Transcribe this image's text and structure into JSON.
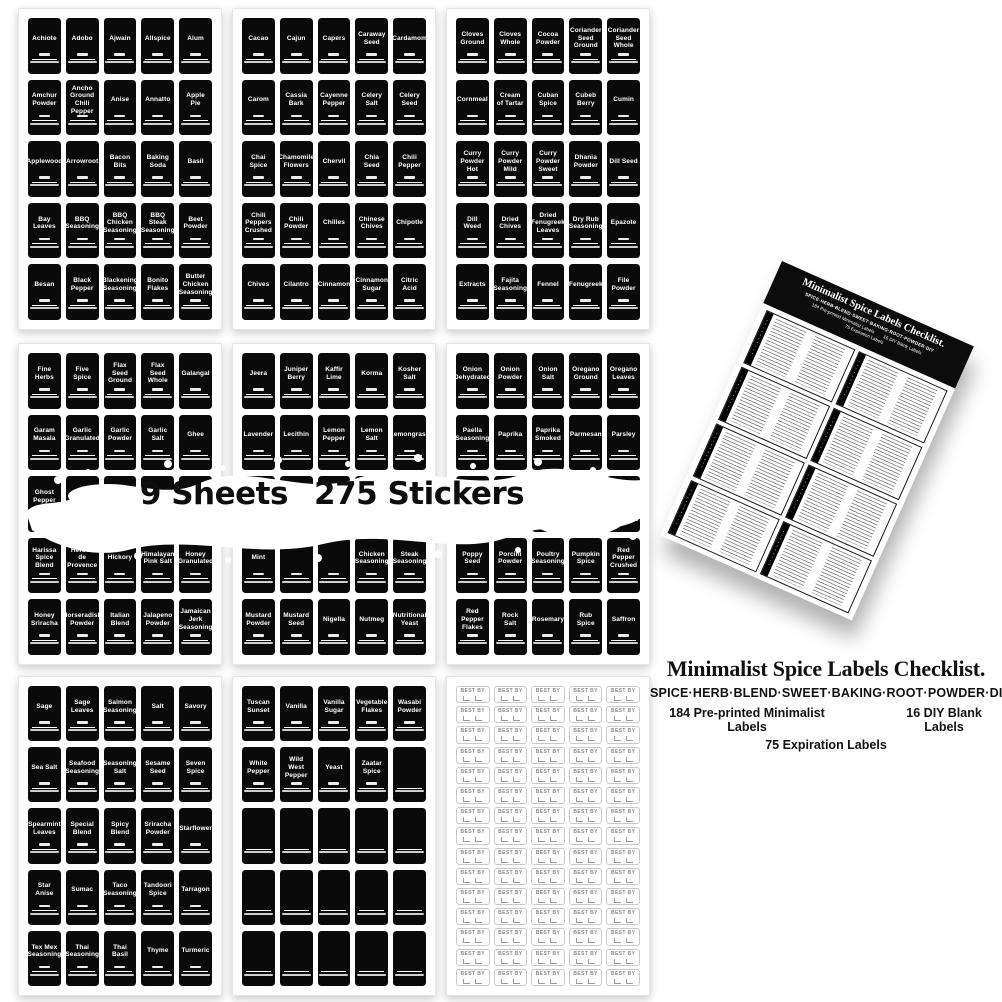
{
  "colors": {
    "background": "#ffffff",
    "label_bg": "#0a0a0a",
    "label_text": "#ffffff",
    "card_header_bg": "#0c0c0c",
    "text": "#111111"
  },
  "banner": {
    "sheets_text": "9 Sheets",
    "stickers_text": "275 Stickers"
  },
  "info": {
    "title": "Minimalist Spice Labels Checklist.",
    "subtitle": "SPICE·HERB·BLEND·SWEET·BAKING·ROOT·POWDER·DIY",
    "line_preprinted": "184 Pre-printed Minimalist Labels",
    "line_blank": "16 DIY Blank Labels",
    "line_expiration": "75 Expiration Labels"
  },
  "card": {
    "title": "Minimalist Spice Labels Checklist.",
    "subtitle": "SPICE·HERB·BLEND·SWEET·BAKING·ROOT·POWDER·DIY",
    "line_preprinted": "184 Pre-printed Minimalist Labels",
    "line_blank": "16 DIY Blank Labels",
    "line_expiration": "75 Expiration Labels",
    "box_count": 8
  },
  "expiration": {
    "text": "BEST BY",
    "rows": 15,
    "cols": 5,
    "count": 75
  },
  "sheets": [
    {
      "name": "sheet-1",
      "rows": 5,
      "cols": 5,
      "labels": [
        "Achiote",
        "Adobo",
        "Ajwain",
        "Allspice",
        "Alum",
        "Amchur Powder",
        "Ancho Ground Chili Pepper",
        "Anise",
        "Annatto",
        "Apple Pie",
        "Applewood",
        "Arrowroot",
        "Bacon Bits",
        "Baking Soda",
        "Basil",
        "Bay Leaves",
        "BBQ Seasoning",
        "BBQ Chicken Seasoning",
        "BBQ Steak Seasoning",
        "Beet Powder",
        "Besan",
        "Black Pepper",
        "Blackening Seasoning",
        "Bonito Flakes",
        "Butter Chicken Seasoning"
      ]
    },
    {
      "name": "sheet-2",
      "rows": 5,
      "cols": 5,
      "labels": [
        "Cacao",
        "Cajun",
        "Capers",
        "Caraway Seed",
        "Cardamom",
        "Carom",
        "Cassia Bark",
        "Cayenne Pepper",
        "Celery Salt",
        "Celery Seed",
        "Chai Spice",
        "Chamomile Flowers",
        "Chervil",
        "Chia Seed",
        "Chili Pepper",
        "Chili Peppers Crushed",
        "Chili Powder",
        "Chilies",
        "Chinese Chives",
        "Chipotle",
        "Chives",
        "Cilantro",
        "Cinnamon",
        "Cinnamon Sugar",
        "Citric Acid"
      ]
    },
    {
      "name": "sheet-3",
      "rows": 5,
      "cols": 5,
      "labels": [
        "Cloves Ground",
        "Cloves Whole",
        "Cocoa Powder",
        "Coriander Seed Ground",
        "Coriander Seed Whole",
        "Cornmeal",
        "Cream of Tartar",
        "Cuban Spice",
        "Cubeb Berry",
        "Cumin",
        "Curry Powder Hot",
        "Curry Powder Mild",
        "Curry Powder Sweet",
        "Dhania Powder",
        "Dill Seed",
        "Dill Weed",
        "Dried Chives",
        "Dried Fenugreek Leaves",
        "Dry Rub Seasoning",
        "Epazote",
        "Extracts",
        "Fajita Seasoning",
        "Fennel",
        "Fenugreek",
        "File Powder"
      ]
    },
    {
      "name": "sheet-4",
      "rows": 5,
      "cols": 5,
      "labels": [
        "Fine Herbs",
        "Five Spice",
        "Flax Seed Ground",
        "Flax Seed Whole",
        "Galangal",
        "Garam Masala",
        "Garlic Granulated",
        "Garlic Powder",
        "Garlic Salt",
        "Ghee",
        "Ghost Pepper",
        "Ginger",
        "",
        "",
        "",
        "Harissa Spice Blend",
        "Herbes de Provence",
        "Hickory",
        "Himalayan Pink Salt",
        "Honey Granulated",
        "Honey Sriracha",
        "Horseradish Powder",
        "Italian Blend",
        "Jalapeno Powder",
        "Jamaican Jerk Seasoning"
      ]
    },
    {
      "name": "sheet-5",
      "rows": 5,
      "cols": 5,
      "labels": [
        "Jeera",
        "Juniper Berry",
        "Kaffir Lime",
        "Korma",
        "Kosher Salt",
        "Lavender",
        "Lecithin",
        "Lemon Pepper",
        "Lemon Salt",
        "Lemongrass",
        "",
        "",
        "",
        "",
        "",
        "Mint",
        "",
        "",
        "Chicken Seasoning",
        "Steak Seasoning",
        "Mustard Powder",
        "Mustard Seed",
        "Nigella",
        "Nutmeg",
        "Nutritional Yeast"
      ]
    },
    {
      "name": "sheet-6",
      "rows": 5,
      "cols": 5,
      "labels": [
        "Onion Dehydrated",
        "Onion Powder",
        "Onion Salt",
        "Oregano Ground",
        "Oregano Leaves",
        "Paella Seasoning",
        "Paprika",
        "Paprika Smoked",
        "Parmesan",
        "Parsley",
        "",
        "",
        "",
        "",
        "Seasoning",
        "Poppy Seed",
        "Porcini Powder",
        "Poultry Seasoning",
        "Pumpkin Spice",
        "Red Pepper Crushed",
        "Red Pepper Flakes",
        "Rock Salt",
        "Rosemary",
        "Rub Spice",
        "Saffron"
      ]
    },
    {
      "name": "sheet-7",
      "rows": 5,
      "cols": 5,
      "labels": [
        "Sage",
        "Sage Leaves",
        "Salmon Seasoning",
        "Salt",
        "Savory",
        "Sea Salt",
        "Seafood Seasoning",
        "Seasoning Salt",
        "Sesame Seed",
        "Seven Spice",
        "Spearmint Leaves",
        "Special Blend",
        "Spicy Blend",
        "Sriracha Powder",
        "Starflower",
        "Star Anise",
        "Sumac",
        "Taco Seasoning",
        "Tandoori Spice",
        "Tarragon",
        "Tex Mex Seasoning",
        "Thai Seasoning",
        "Thai Basil",
        "Thyme",
        "Turmeric"
      ]
    },
    {
      "name": "sheet-8",
      "rows": 5,
      "cols": 5,
      "labels": [
        "Tuscan Sunset",
        "Vanilla",
        "Vanilla Sugar",
        "Vegetable Flakes",
        "Wasabi Powder",
        "White Pepper",
        "Wild West Pepper",
        "Yeast",
        "Zaatar Spice",
        "",
        "",
        "",
        "",
        "",
        "",
        "",
        "",
        "",
        "",
        "",
        "",
        "",
        "",
        "",
        ""
      ]
    }
  ]
}
